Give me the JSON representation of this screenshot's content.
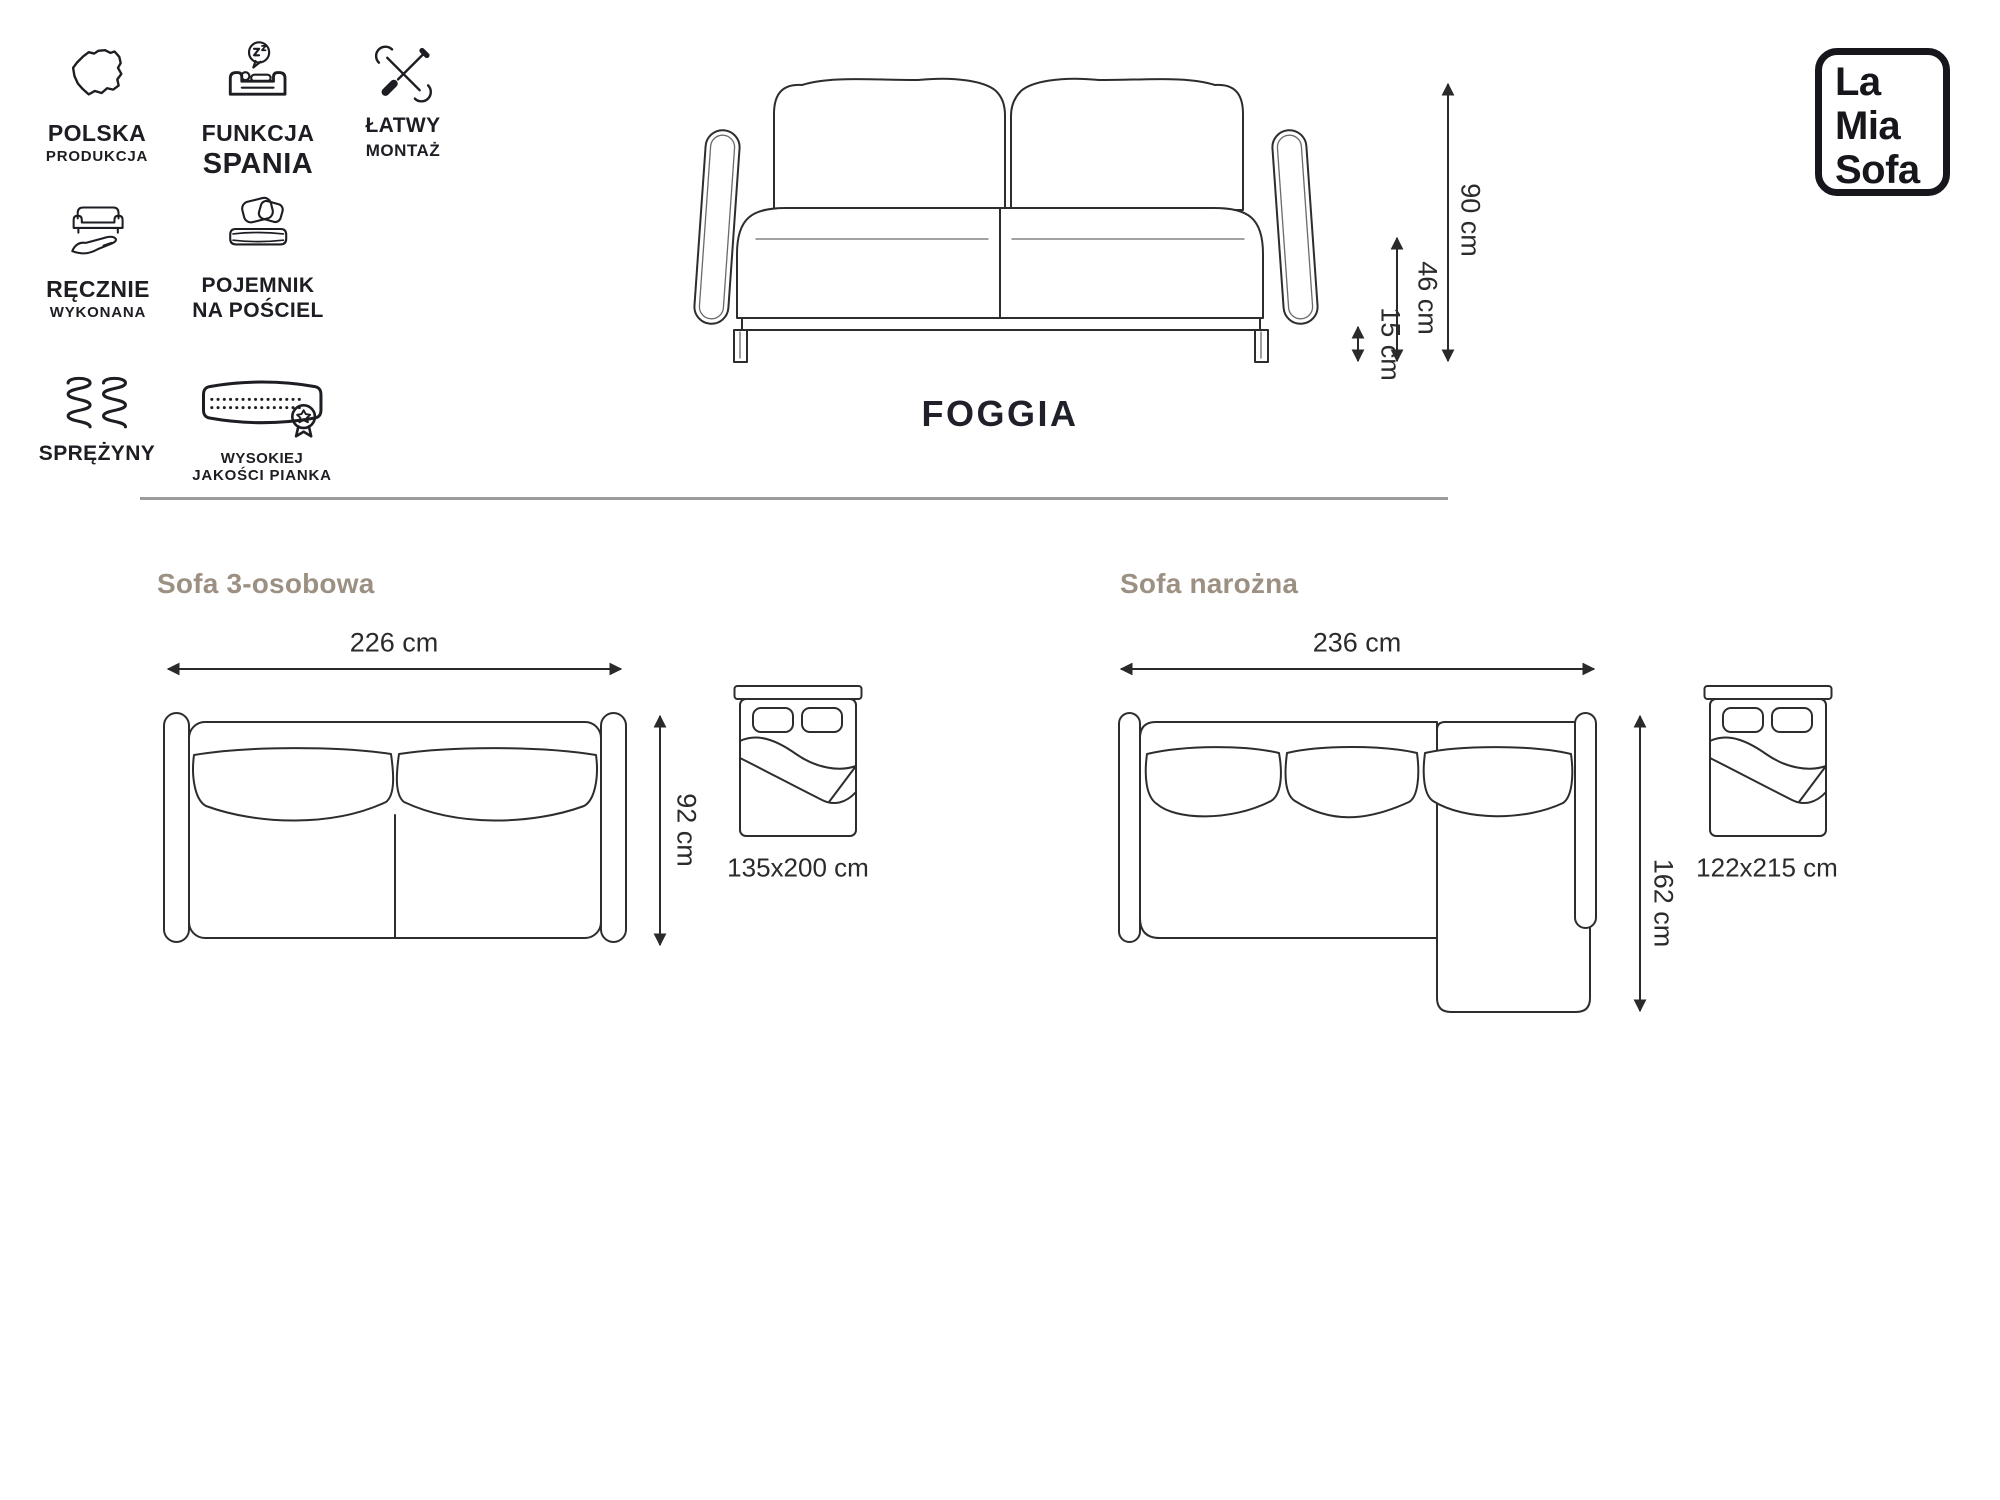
{
  "product": {
    "name": "FOGGIA"
  },
  "brand": {
    "lines": [
      "La",
      "Mia",
      "Sofa"
    ]
  },
  "features": [
    {
      "icon": "poland-map-icon",
      "line1": "POLSKA",
      "line2": "PRODUKCJA"
    },
    {
      "icon": "sleep-function-icon",
      "line1": "FUNKCJA",
      "line2": "SPANIA"
    },
    {
      "icon": "easy-assembly-icon",
      "line1": "ŁATWY",
      "line2": "MONTAŻ"
    },
    {
      "icon": "handmade-icon",
      "line1": "RĘCZNIE",
      "line2": "WYKONANA"
    },
    {
      "icon": "bedding-storage-icon",
      "line1": "POJEMNIK",
      "line2": "NA POŚCIEL"
    },
    {
      "icon": "springs-icon",
      "line1": "SPRĘŻYNY",
      "line2": ""
    },
    {
      "icon": "foam-quality-icon",
      "line1": "WYSOKIEJ",
      "line2": "JAKOŚCI PIANKA"
    }
  ],
  "front_view": {
    "height": "90 cm",
    "seat_height": "46 cm",
    "legs_height": "15 cm"
  },
  "sections": {
    "sofa3": {
      "title": "Sofa 3-osobowa",
      "width": "226 cm",
      "depth": "92 cm",
      "bed_size": "135x200 cm"
    },
    "corner": {
      "title": "Sofa narożna",
      "width": "236 cm",
      "depth": "162 cm",
      "bed_size": "122x215 cm"
    }
  },
  "colors": {
    "text": "#1d1d23",
    "heading": "#9c9083",
    "line": "#2d2d2d",
    "divider": "#9b9b9b"
  }
}
